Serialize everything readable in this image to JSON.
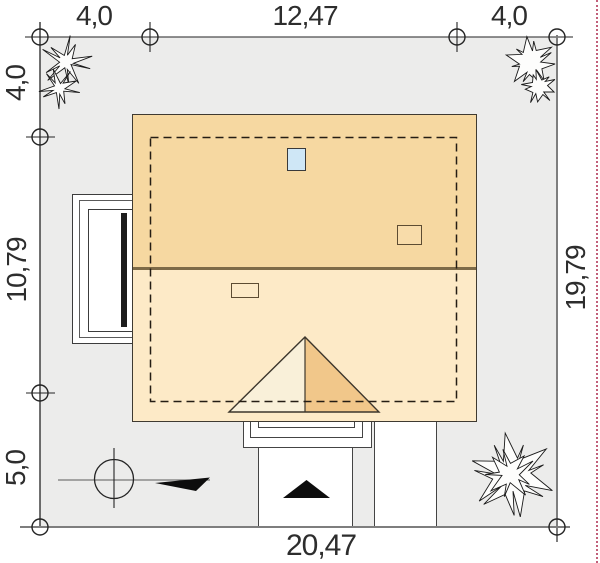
{
  "site_plan": {
    "dimension_labels": {
      "top_left_margin": "4,0",
      "top_building_width": "12,47",
      "top_right_margin": "4,0",
      "left_top_margin": "4,0",
      "left_building_depth": "10,79",
      "left_bottom_margin": "5,0",
      "right_plot_depth": "19,79",
      "bottom_plot_width": "20,47"
    },
    "colors": {
      "page_background": "#ffffff",
      "plot_background": "#ececeb",
      "roof_upper_slope": "#f6d8a1",
      "roof_lower_slope": "#fdeac7",
      "gable_left_half": "#f9f0d9",
      "gable_right_half": "#f1c78a",
      "skylight_blue": "#cfe7f6",
      "outline_dark": "#3f3a31",
      "ridge_brown": "#7d6a47",
      "boundary_gray": "#7e7e7e",
      "setback_marker_pink": "#c1607a",
      "text": "#2d2d2d"
    },
    "icons": {
      "conifer-tree-icon": "spiky hand-sketched tree",
      "shrub-tree-icon": "two round spiky shrubs",
      "bush-tree-icon": "leafy round bush",
      "north-compass-icon": "circle with cross and black arrow",
      "entrance-arrow-icon": "black triangle entrance marker",
      "survey-marker-icon": "small circle with cross on boundary"
    }
  }
}
